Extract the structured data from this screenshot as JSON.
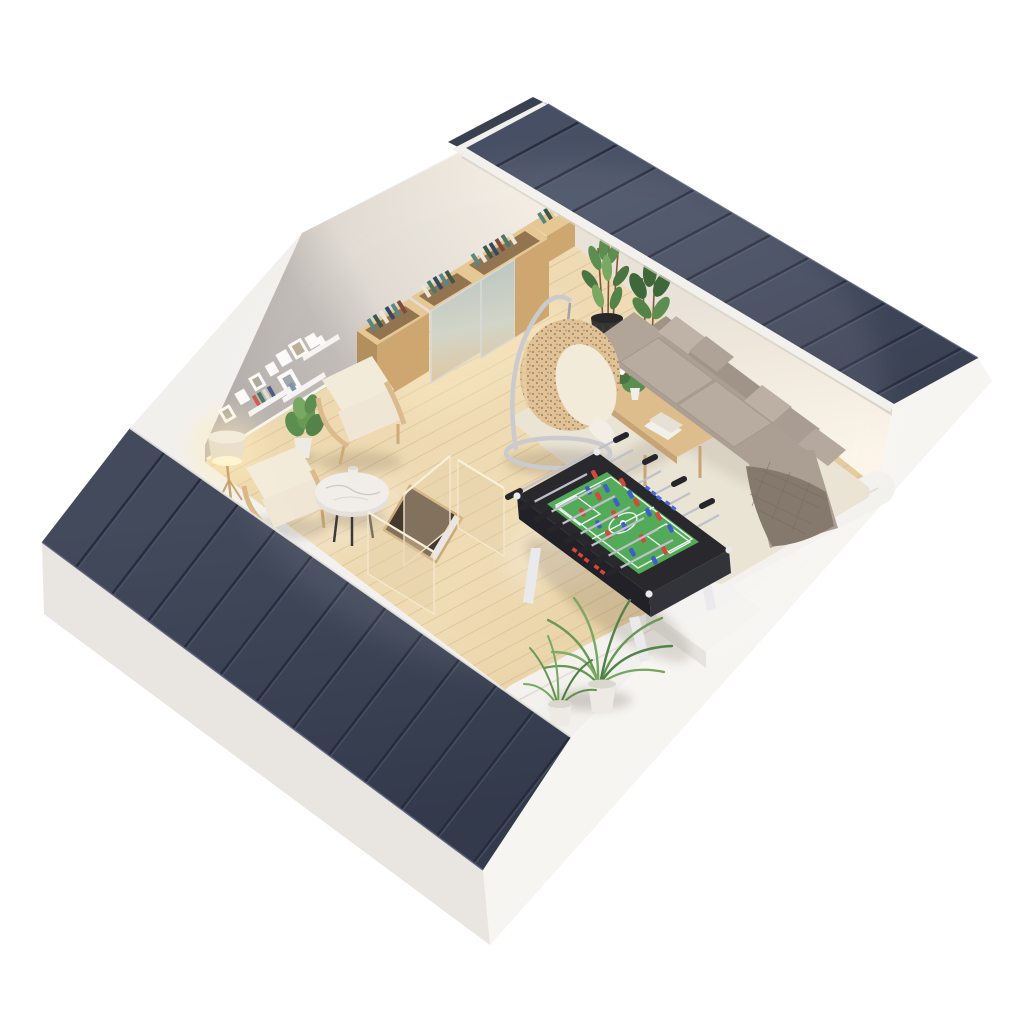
{
  "scene": {
    "description": "3D isometric cutaway render of an attic lounge: navy standing-seam roof planes removed over a wood-floored room with wardrobe cabinets, hanging egg chair, L-shaped sofa, foosball table, armchairs, glass stair balustrade and potted plants",
    "view": "axonometric dollhouse top-floor plan"
  },
  "palette": {
    "bg": "#ffffff",
    "base_wall": "#f2f0ed",
    "base_wall_sw": "#e9e6e2",
    "base_wall_se": "#f7f5f2",
    "roof_left": "#3e4557",
    "roof_right": "#424a5e",
    "roof_sliver": "#394050",
    "roof_seam": "#272c3c",
    "fascia": "#f2f0ec",
    "wall_gray": "#b2acaa",
    "wall_ne_top": "#e8e0d5",
    "baseboard": "#f7f5f2",
    "floor": "#e9d2a4",
    "plank": "#c9ad7f",
    "wall_band": "#f3f1ee",
    "cabinet_wood": "#c9a164",
    "cabinet_wood_light": "#e5c48d",
    "cabinet_wood_dark": "#ad8751",
    "cabinet_inner": "#8a6a42",
    "mirror_top": "#b9c4bd",
    "sofa": "#a5978b",
    "sofa_light": "#b3a598",
    "sofa_dark": "#8f8174",
    "blanket": "#7c6e62",
    "rug": "#e9e2d2",
    "table_wood": "#dcb883",
    "marble": "#f0ede9",
    "rattan": "#dfbd8e",
    "rattan_dot": "#6b5436",
    "cushion": "#f3ead8",
    "metal": "#c6c6cc",
    "lamp_shade": "#e9dec6",
    "glass": "#e2cba0",
    "stair_dark": "#37291e",
    "foosball_body": "#17171d",
    "foosball_field": "#46a44c",
    "player_red": "#cf3b2e",
    "player_blue": "#2f52c4",
    "rod": "#b9bdc6",
    "plant_dark": "#2f5c2a",
    "plant": "#518544",
    "plant_light": "#6fa257",
    "palm": "#5d9148",
    "pot_black": "#252525",
    "pot_white": "#eceae3",
    "white": "#fdfcfa"
  },
  "furniture": {
    "cabinets": "oak wardrobe with mirror sliding doors and open book tops",
    "egg_chair": "rattan hanging egg chair on steel stand",
    "sofa": "L-shaped taupe sectional sofa with blanket",
    "coffee_table": "wood coffee table with flowers",
    "foosball": "foosball table, red vs blue teams",
    "armchairs": "two cream lounge armchairs",
    "side_table": "round marble side table",
    "lamp": "floor lamp, lit",
    "stairs": "stair opening with glass balustrade",
    "plants": "potted green plants and palms",
    "frames": "gallery picture frames and shelves"
  }
}
